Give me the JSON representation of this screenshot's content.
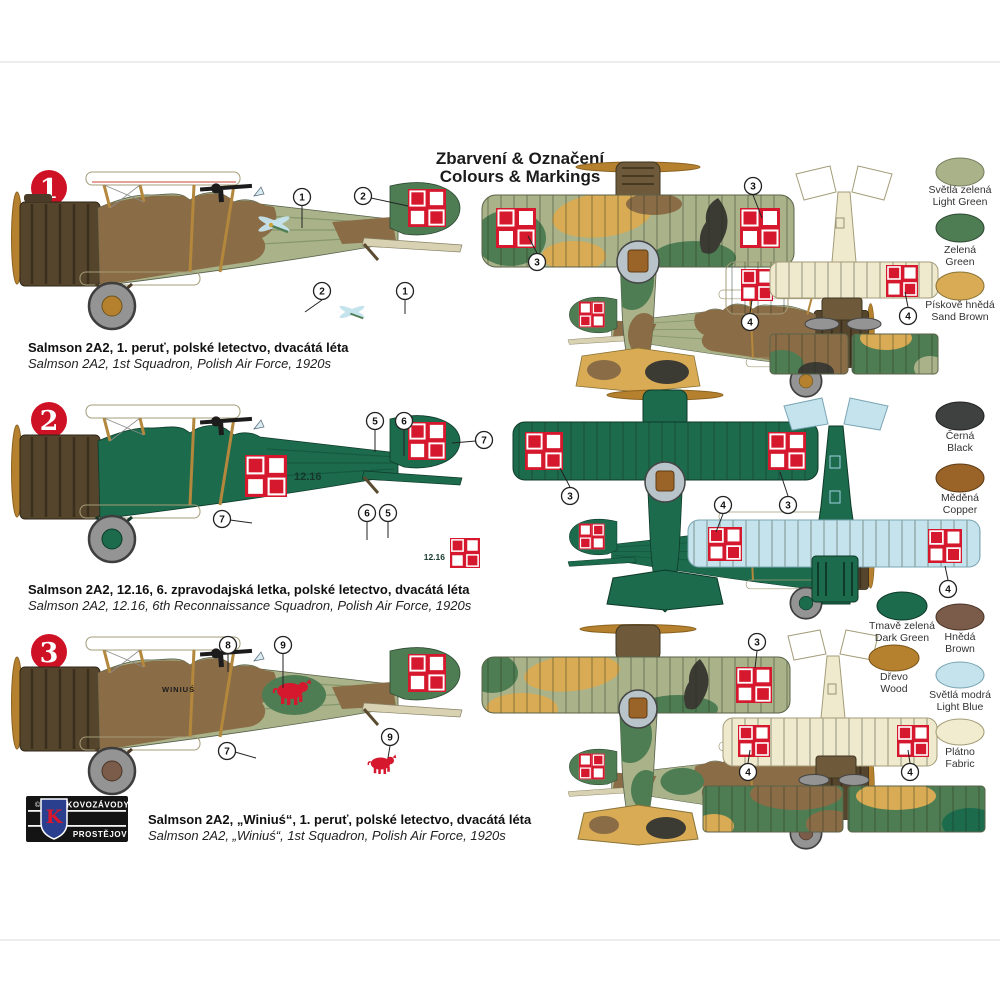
{
  "title": {
    "line1": "Zbarvení & Označení",
    "line2": "Colours & Markings"
  },
  "schemes": [
    {
      "number": "1",
      "caption_cs": "Salmson 2A2, 1. peruť, polské letectvo, dvacátá léta",
      "caption_en": "Salmson 2A2, 1st Squadron, Polish Air Force, 1920s",
      "code": "",
      "emblem": "dragonfly"
    },
    {
      "number": "2",
      "caption_cs": "Salmson 2A2, 12.16, 6. zpravodajská letka, polské letectvo, dvacátá léta",
      "caption_en": "Salmson 2A2, 12.16, 6th Reconnaissance Squadron, Polish Air Force, 1920s",
      "code": "12.16",
      "emblem": ""
    },
    {
      "number": "3",
      "caption_cs": "Salmson 2A2, „Winiuś“, 1. peruť, polské letectvo, dvacátá léta",
      "caption_en": "Salmson 2A2, „Winiuś“, 1st Squadron, Polish Air Force, 1920s",
      "code": "WINIUŚ",
      "emblem": "red boar"
    }
  ],
  "callouts": {
    "n1": "1",
    "n2": "2",
    "n3": "3",
    "n4": "4",
    "n5": "5",
    "n6": "6",
    "n7": "7",
    "n8": "8",
    "n9": "9"
  },
  "palette": [
    {
      "cs": "Světlá zelená",
      "en": "Light Green",
      "hex": "#a9b289"
    },
    {
      "cs": "Zelená",
      "en": "Green",
      "hex": "#4e7d53"
    },
    {
      "cs": "Pískově hnědá",
      "en": "Sand Brown",
      "hex": "#d9ab55"
    },
    {
      "cs": "Černá",
      "en": "Black",
      "hex": "#3f4040"
    },
    {
      "cs": "Měděná",
      "en": "Copper",
      "hex": "#9a6428"
    },
    {
      "cs": "Tmavě zelená",
      "en": "Dark Green",
      "hex": "#1c6b4d"
    },
    {
      "cs": "Dřevo",
      "en": "Wood",
      "hex": "#b5812e"
    },
    {
      "cs": "Hnědá",
      "en": "Brown",
      "hex": "#7b5b49"
    },
    {
      "cs": "Světlá modrá",
      "en": "Light Blue",
      "hex": "#c5e3ed"
    },
    {
      "cs": "Plátno",
      "en": "Fabric",
      "hex": "#f1eccf"
    }
  ],
  "colors": {
    "red": "#d6182e",
    "cream": "#efe9cd",
    "light_green": "#a9b289",
    "green": "#4e7d53",
    "dark_green": "#1c6b4d",
    "sand": "#d9ab55",
    "black_patch": "#3b3b33",
    "brown_camo": "#8a6c46",
    "engine_dark": "#55452d",
    "engine_mid": "#6e5a3b",
    "copper": "#9a6428",
    "wood": "#b5812e",
    "light_blue": "#c5e3ed",
    "wheel_gray": "#949494",
    "strut": "#b3873c",
    "brown": "#7b5b49",
    "stripe_green": "#87976d",
    "stripe_dark": "#155a40",
    "ring_gray": "#b9c4ca",
    "badge_red": "#cf1126",
    "logo_blue": "#2b3f8f"
  },
  "logo": {
    "copyright": "©",
    "monogram": "K",
    "line1": "KOVOZÁVODY",
    "line2": "PROSTĚJOV"
  }
}
